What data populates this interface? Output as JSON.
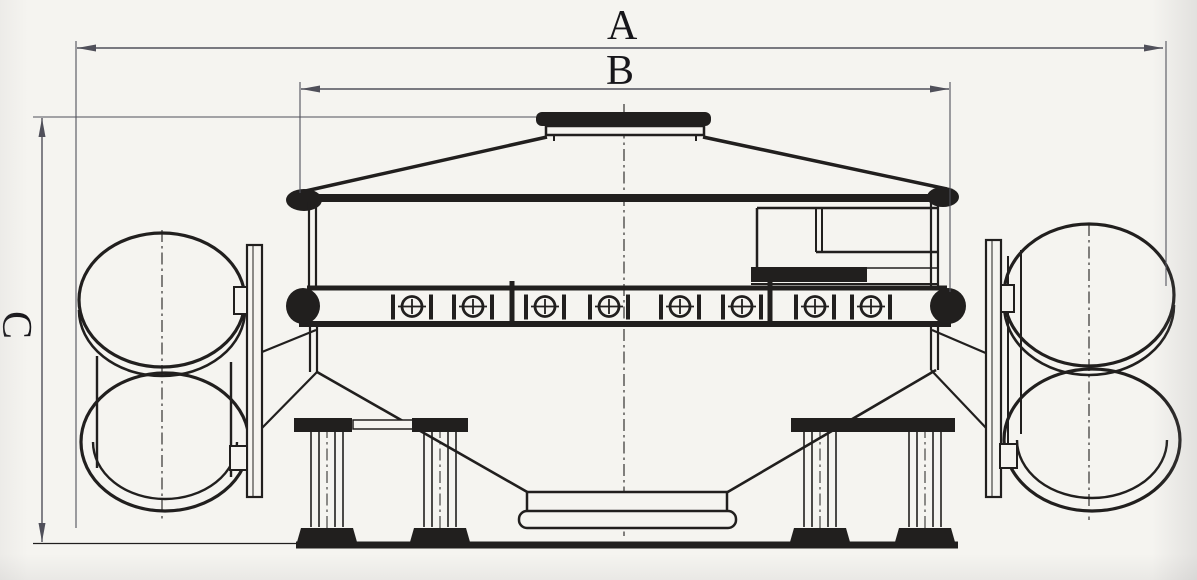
{
  "sheet": {
    "colors": {
      "paper": "#f5f4f0",
      "ink": "#211f1e",
      "dim": "#50505a"
    }
  },
  "dimensions": {
    "a": {
      "label": "A",
      "orientation": "horizontal-overall-width"
    },
    "b": {
      "label": "B",
      "orientation": "horizontal-body-width"
    },
    "c": {
      "label": "C",
      "orientation": "vertical-overall-height"
    }
  }
}
